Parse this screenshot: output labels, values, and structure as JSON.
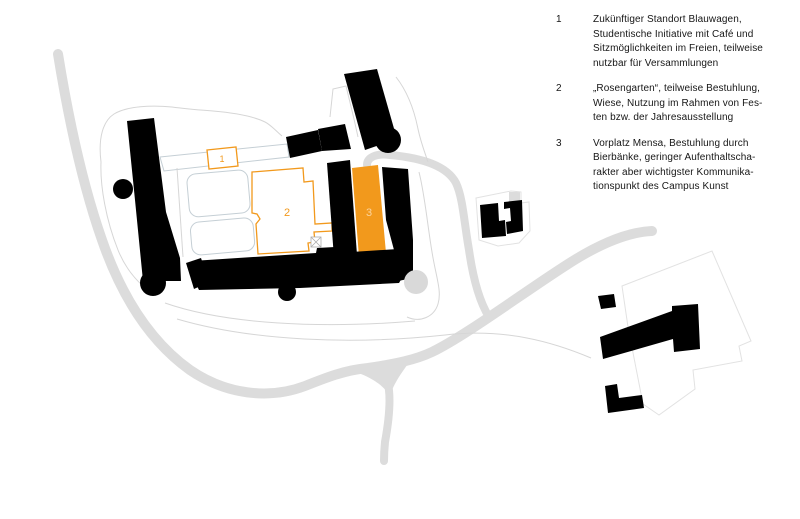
{
  "map": {
    "labels": {
      "area1": "1",
      "area2": "2",
      "area3": "3"
    },
    "colors": {
      "highlight_orange": "#F2991C",
      "area3_label": "#FBD49E",
      "building_black": "#000000",
      "road_gray": "#DCDCDC",
      "contour_gray": "#D6D6D6",
      "courtyard_line": "#C5CFD5"
    }
  },
  "legend": {
    "items": [
      {
        "num": "1",
        "text": "Zukünftiger Standort Blauwagen,\nStudentische Initiative mit Café und\nSitzmöglichkeiten im Freien, teilweise\nnutzbar für Versammlungen"
      },
      {
        "num": "2",
        "text": "„Rosengarten“, teilweise Bestuhlung,\nWiese, Nutzung im Rahmen von Fes-\nten bzw. der Jahresausstellung"
      },
      {
        "num": "3",
        "text": "Vorplatz Mensa, Bestuhlung durch\nBierbänke, geringer Aufenthaltscha-\nrakter aber wichtigster Kommunika-\ntionspunkt des Campus Kunst"
      }
    ]
  }
}
